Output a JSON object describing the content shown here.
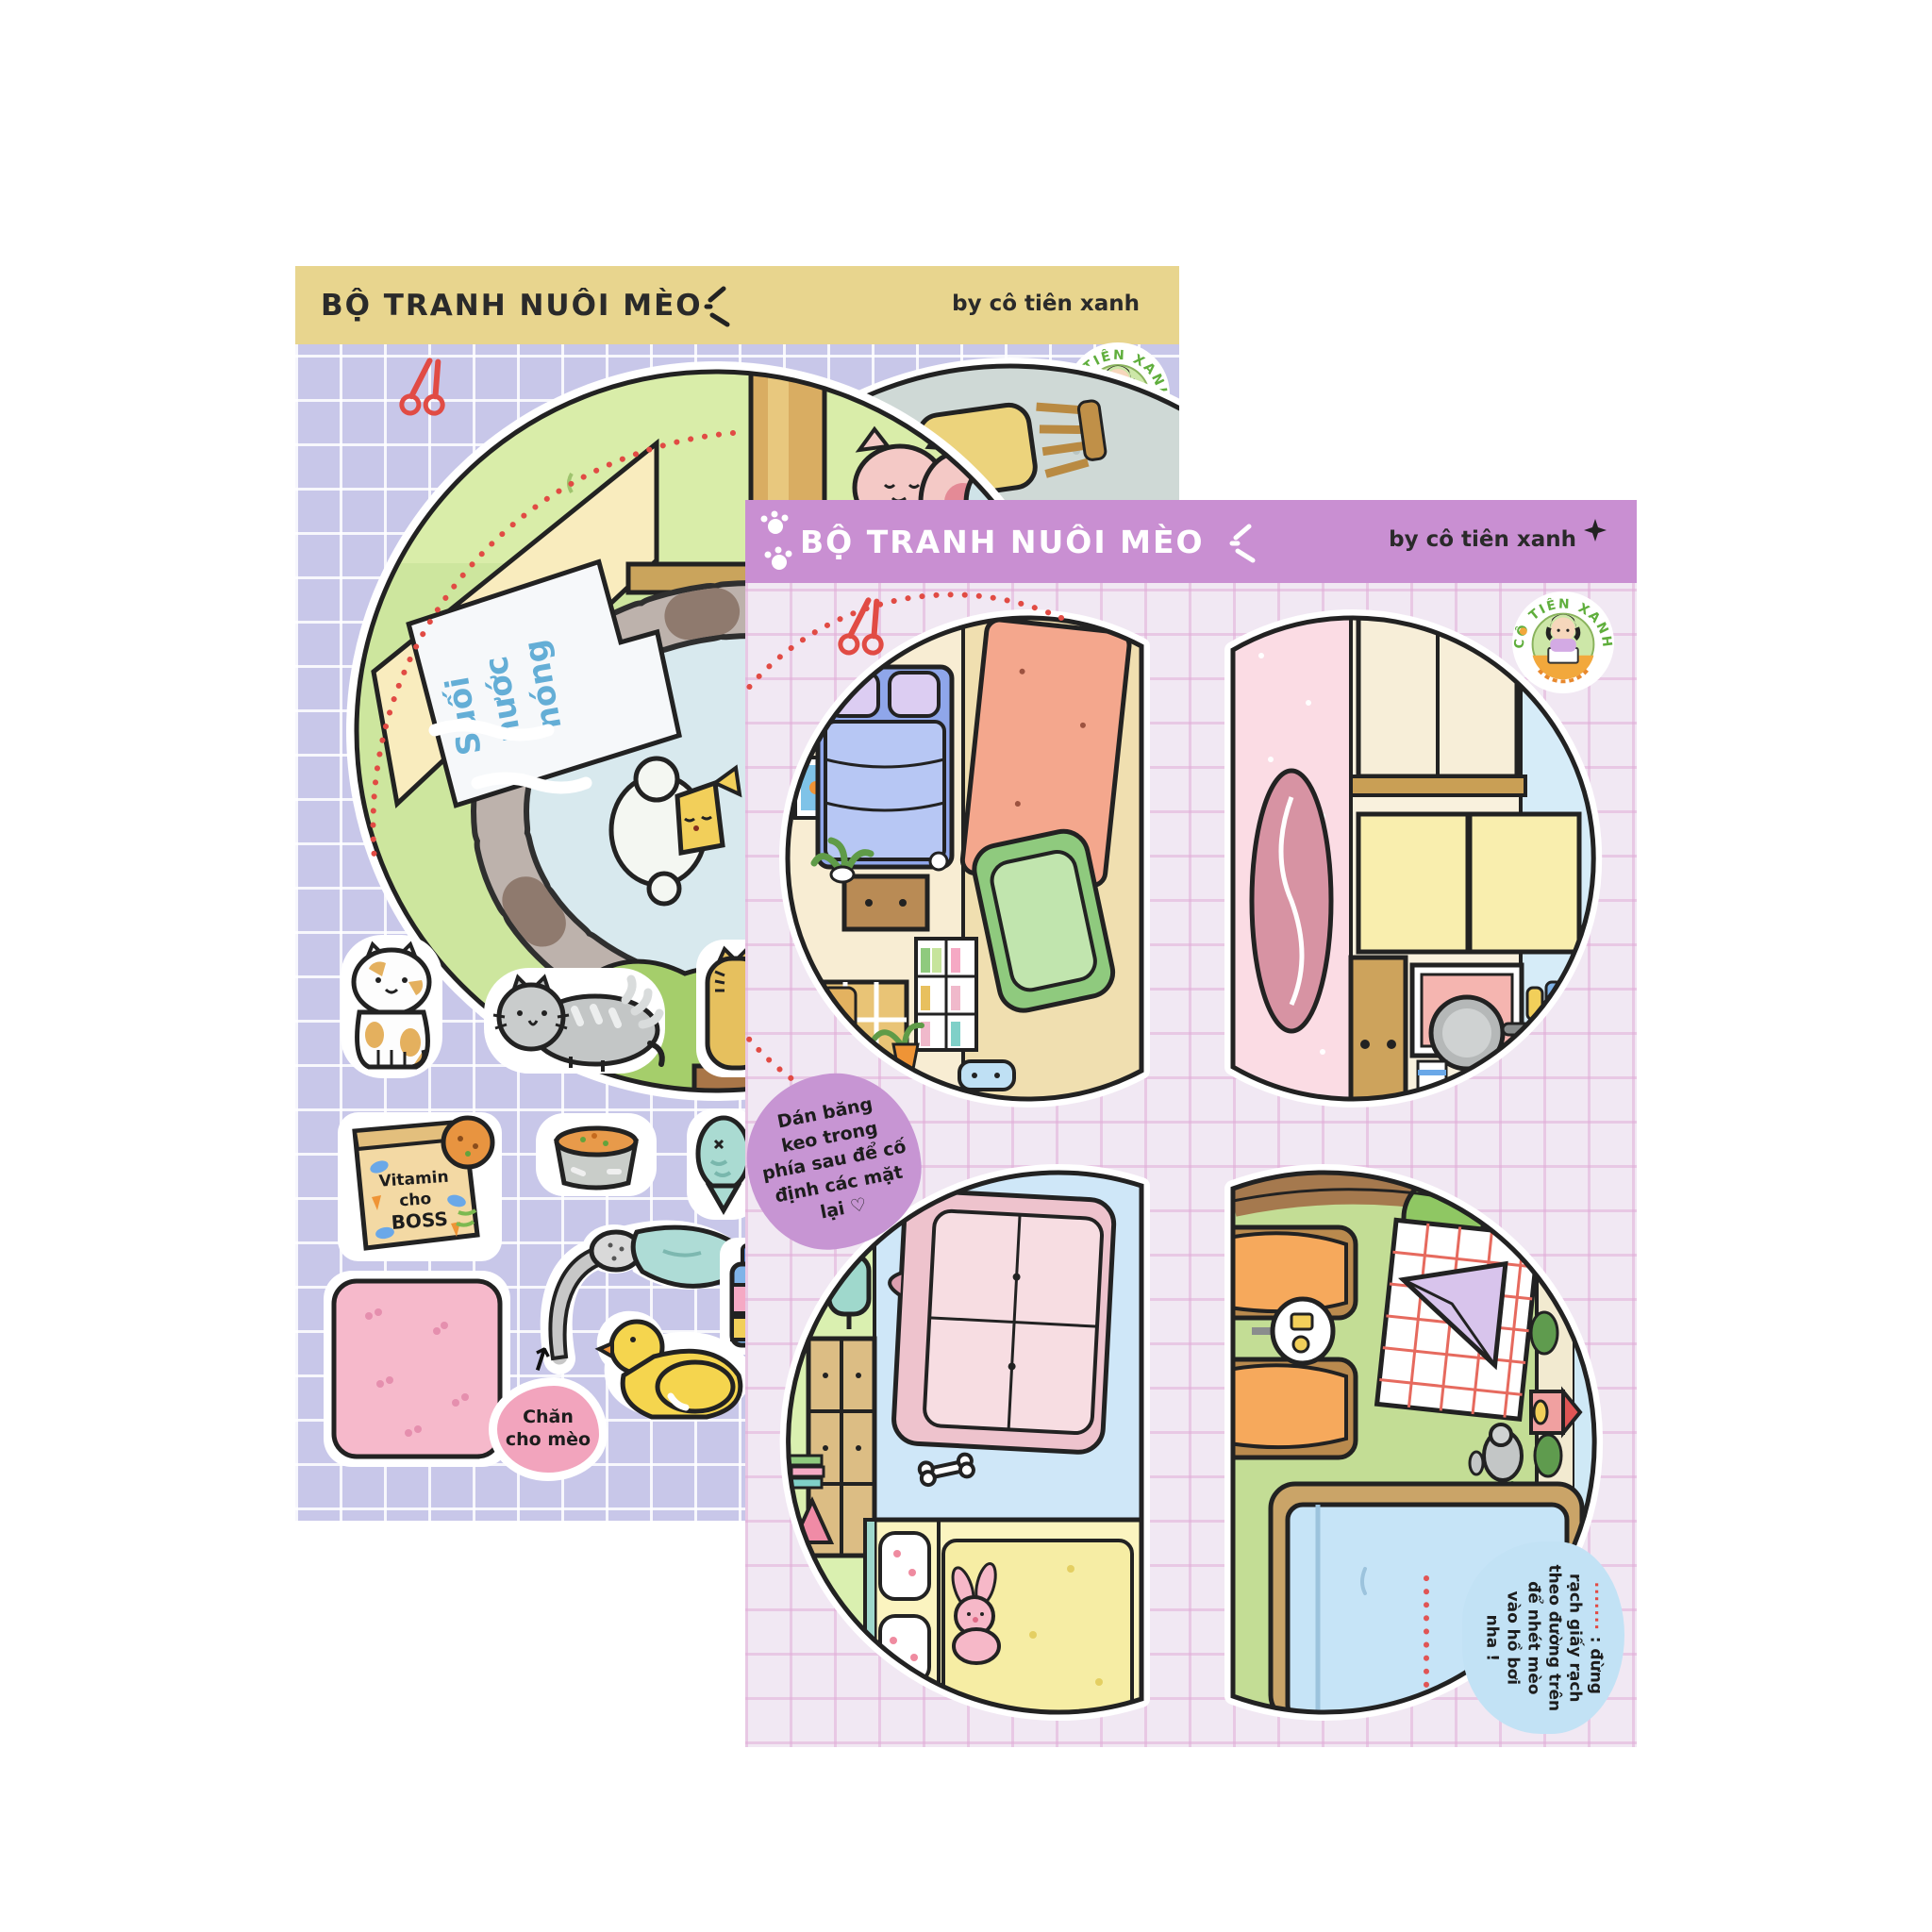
{
  "badge": {
    "brand": "CÔ TIÊN XANH"
  },
  "sheet_yellow": {
    "title": "BỘ TRANH NUÔI MÈO",
    "byline": "by cô tiên xanh",
    "colors": {
      "header": "#e8d58e",
      "body": "#c8c7e9",
      "accent_red": "#e14b44"
    },
    "sign": {
      "l1": "Suối",
      "l2": "nước",
      "l3": "nóng"
    },
    "vitamin": {
      "l1": "Vitamin",
      "l2": "cho",
      "l3": "BOSS"
    },
    "blanket_label": "Chăn\ncho mèo"
  },
  "sheet_purple": {
    "title": "BỘ TRANH NUÔI MÈO",
    "byline": "by cô tiên xanh",
    "colors": {
      "header": "#c98fd2",
      "body": "#f1e8f3",
      "tape_bubble": "#c795d3",
      "cut_bubble": "#c2e2f5"
    },
    "tape_note": "Dán băng\nkeo trong\nphía sau để cố\nđịnh các mặt\nlại ♡",
    "cut_note": {
      "dots": "·······",
      "text": " : đừng\nrạch giấy rạch\ntheo đường trên\nđể nhét mèo\nvào hồ bơi\nnha !"
    }
  }
}
